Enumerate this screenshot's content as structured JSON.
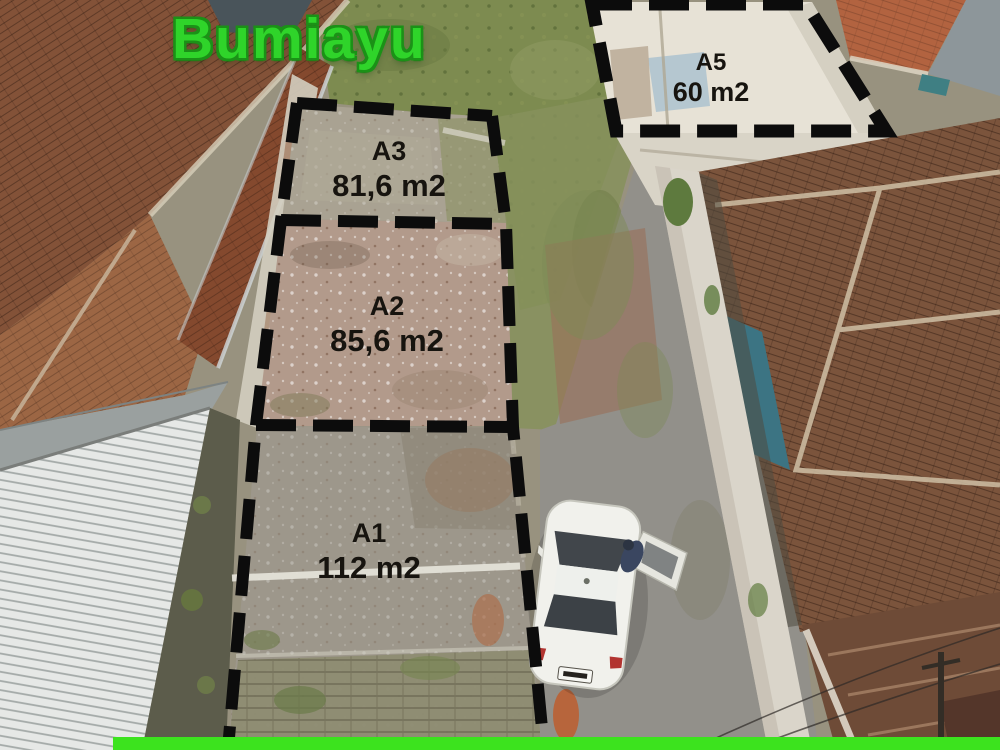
{
  "title": {
    "text": "Bumiayu"
  },
  "plots": [
    {
      "id": "A1",
      "label": "A1",
      "area": "112 m2"
    },
    {
      "id": "A2",
      "label": "A2",
      "area": "85,6 m2"
    },
    {
      "id": "A3",
      "label": "A3",
      "area": "81,6 m2"
    },
    {
      "id": "A5",
      "label": "A5",
      "area": "60 m2"
    }
  ],
  "colors": {
    "title_green": "#2fd42a",
    "footer_bar_green": "#3ce31e",
    "boundary_black": "#0c0c0c"
  }
}
